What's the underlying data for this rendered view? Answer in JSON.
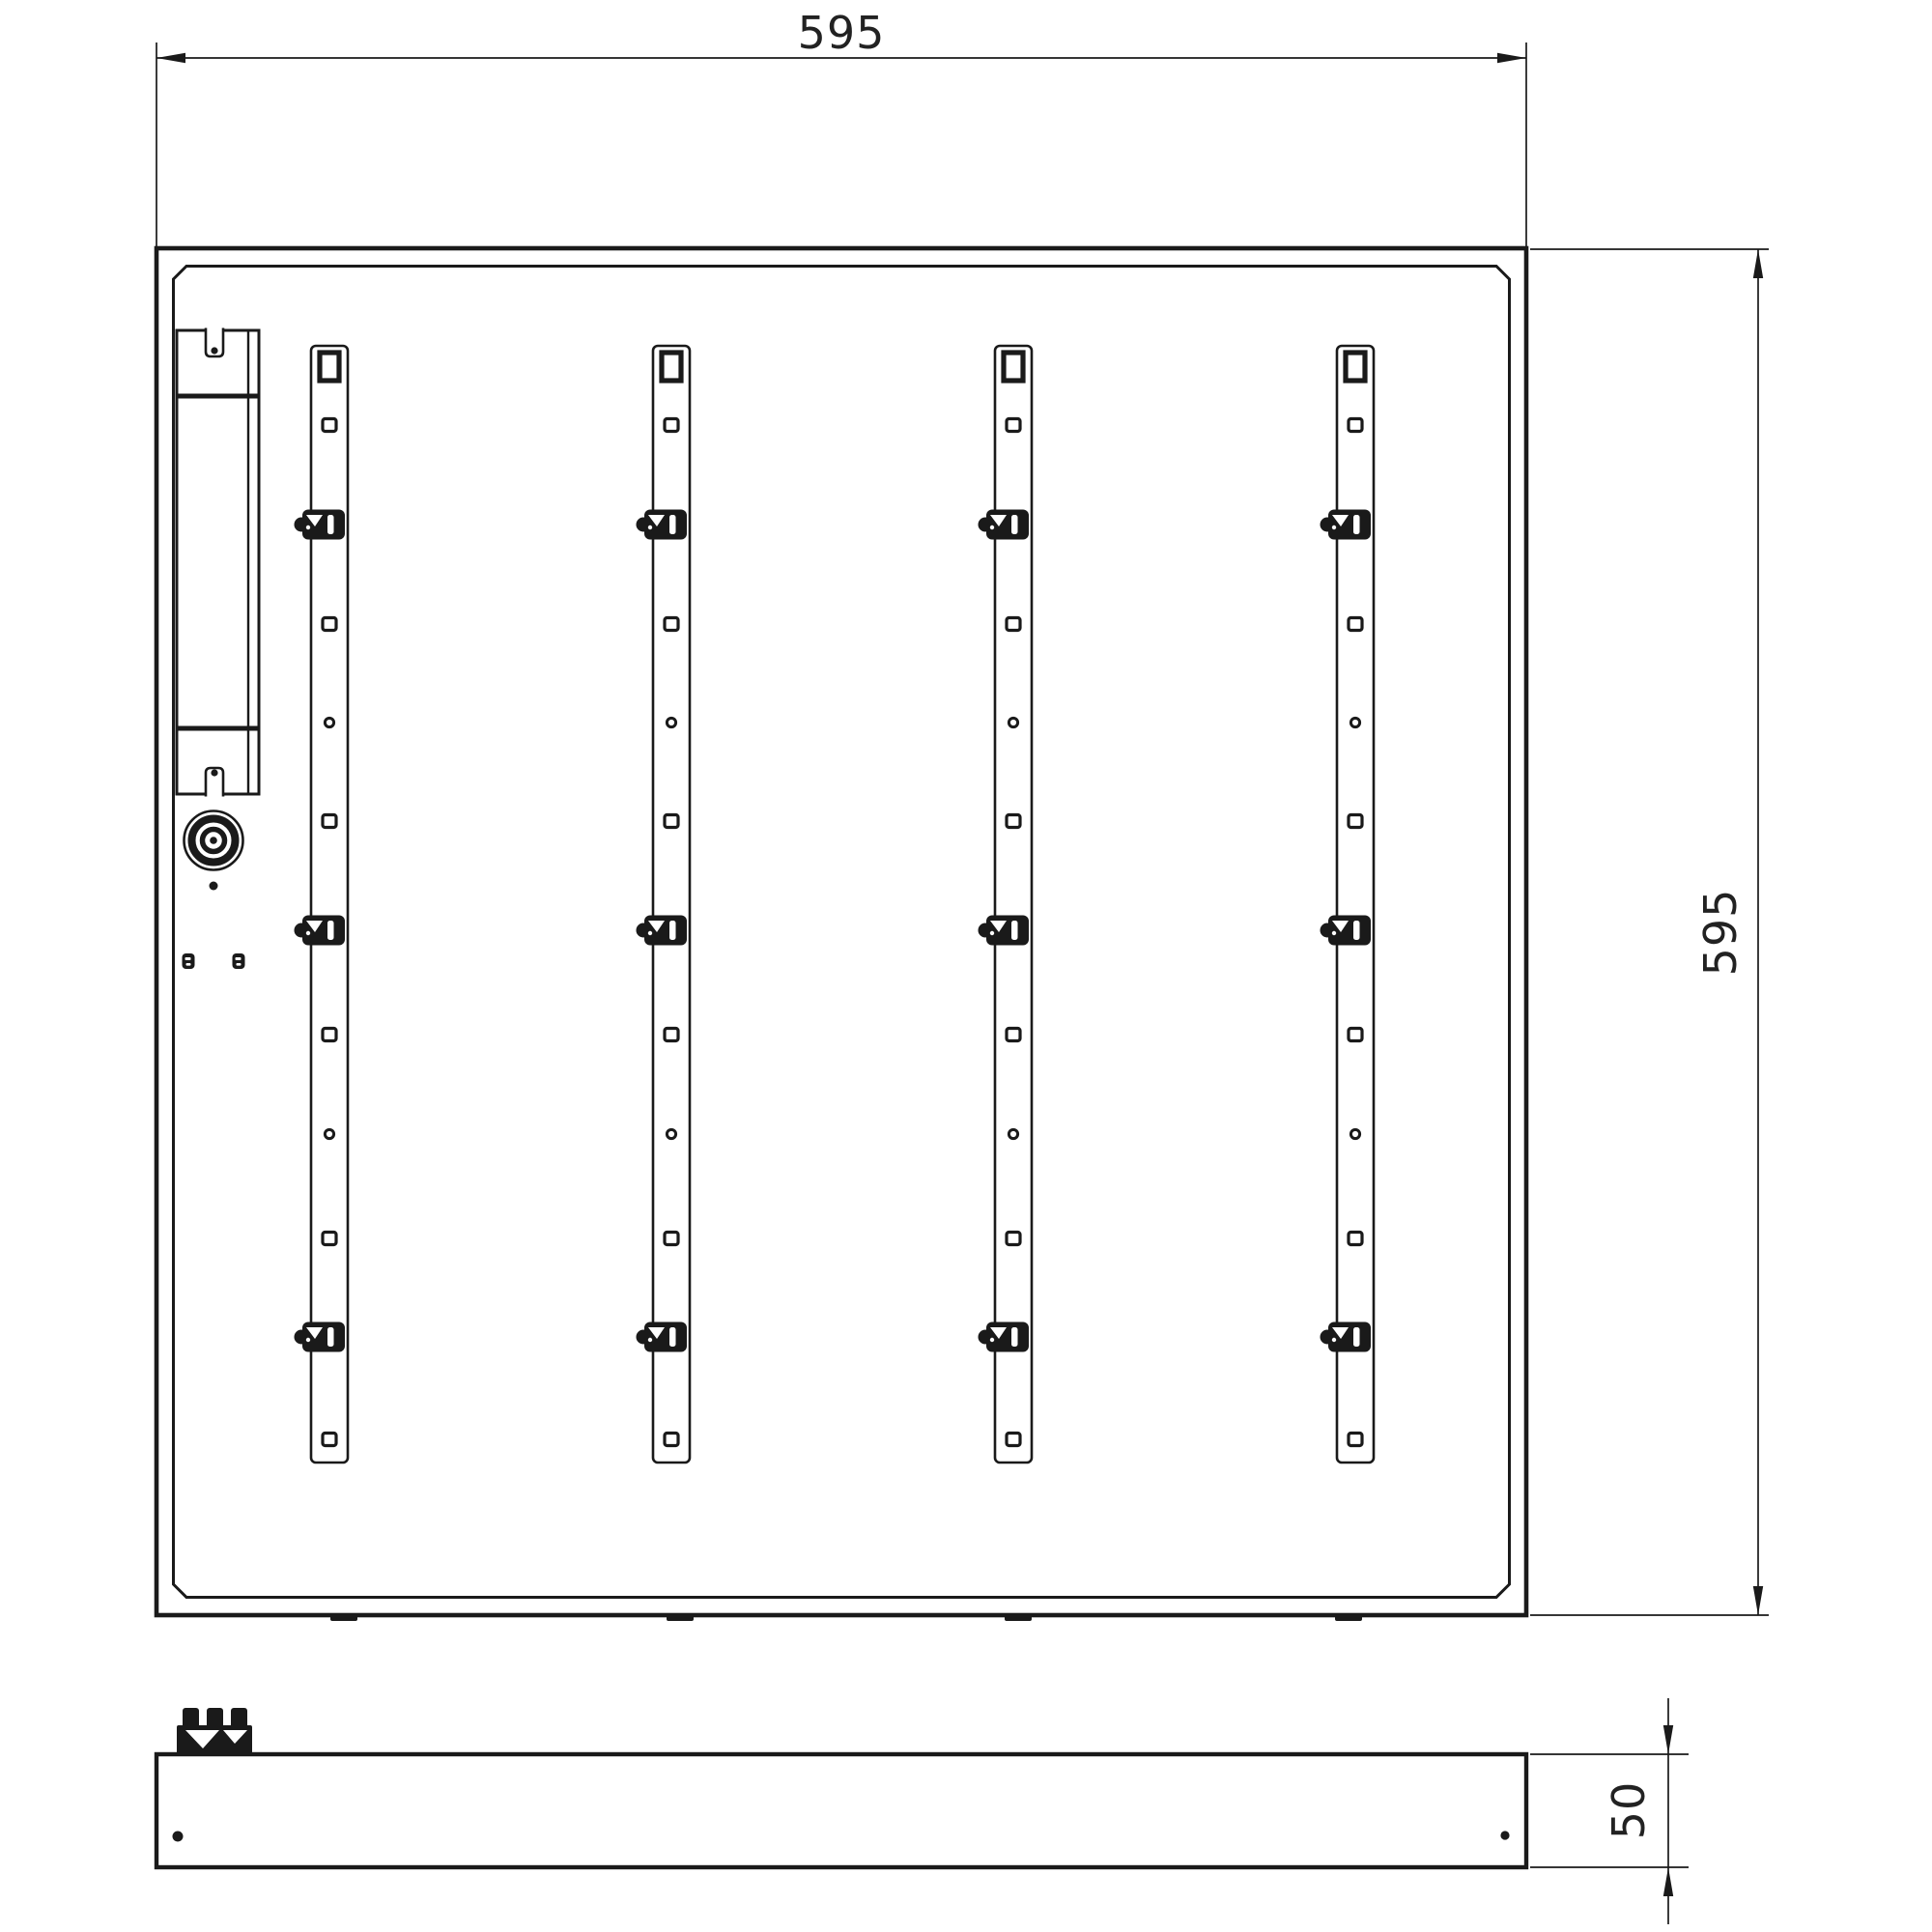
{
  "dimensions": {
    "width": "595",
    "height": "595",
    "depth": "50"
  },
  "structure": {
    "led_strips": 4,
    "clips_per_strip": 3,
    "screw_holes_per_strip": 6,
    "pilot_holes_per_strip": 2
  },
  "colors": {
    "ink": "#1a1a1a",
    "background": "#ffffff"
  }
}
